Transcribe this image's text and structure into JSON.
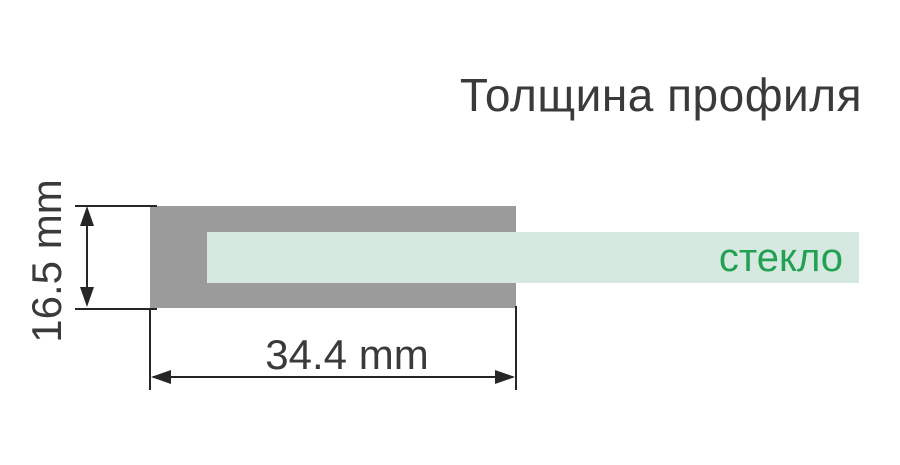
{
  "title": "Толщина профиля",
  "diagram": {
    "glass_label": "стекло",
    "height_dimension": "16.5 mm",
    "width_dimension": "34.4 mm"
  },
  "colors": {
    "profile_gray": "#9b9b9b",
    "glass_mint": "#d6e9e0",
    "glass_green": "#22a152",
    "text_dark": "#3a3a3a",
    "line_dark": "#262626"
  }
}
